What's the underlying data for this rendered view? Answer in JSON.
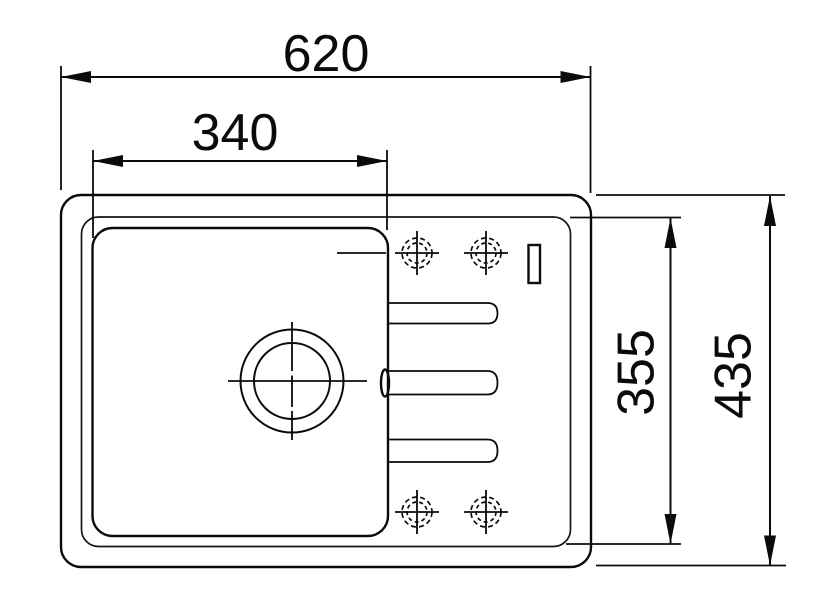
{
  "page": {
    "background": "#ffffff",
    "line_color": "#0b0b0b"
  },
  "drawing": {
    "type": "technical dimension drawing",
    "subject": "kitchen sink with single bowl and drainboard, top view",
    "dimensions": [
      {
        "id": "overall-width",
        "label": "620",
        "orientation": "horizontal",
        "measures": "outer rim width"
      },
      {
        "id": "bowl-width",
        "label": "340",
        "orientation": "horizontal",
        "measures": "bowl width"
      },
      {
        "id": "inner-depth",
        "label": "355",
        "orientation": "vertical",
        "measures": "inner basin depth"
      },
      {
        "id": "overall-depth",
        "label": "435",
        "orientation": "vertical",
        "measures": "outer rim depth"
      }
    ],
    "features": {
      "faucet_holes": 4,
      "drain_circles": 2,
      "drainboard_grooves": 3,
      "overflow_slot": 1
    }
  }
}
